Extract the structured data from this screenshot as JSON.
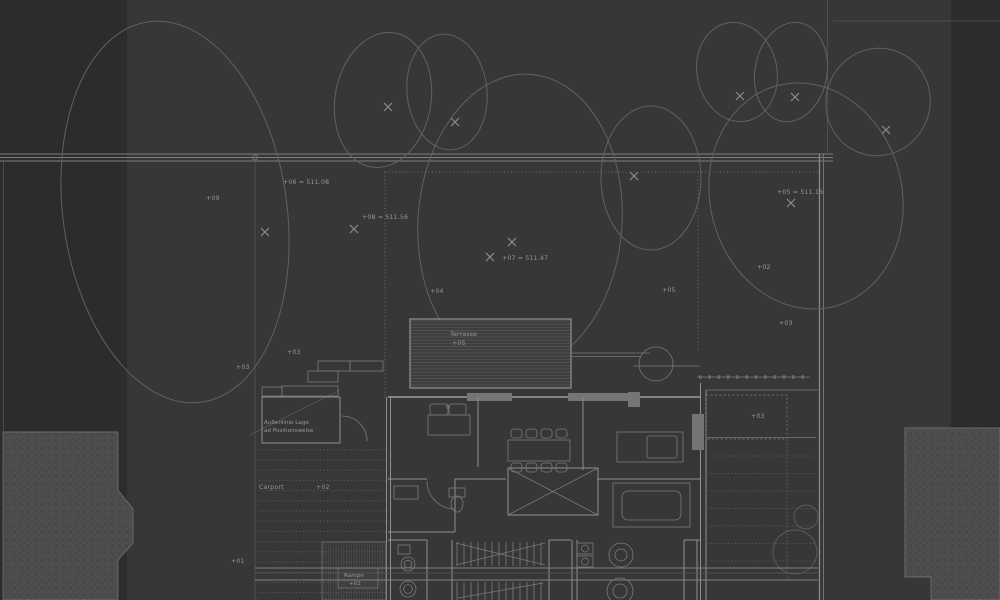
{
  "document": {
    "type": "architectural-site-plan",
    "style": "dark CAD / Lageplan view with tree canopies, neighbouring buildings and ground-floor furniture plan"
  },
  "colors": {
    "background": "#373737",
    "margin_strip": "#2c2c2c",
    "linework": "#8f8f8f",
    "tree_outline": "#616161",
    "hatch_fill": "#474747",
    "annotation_text": "#969696"
  },
  "icons": {
    "tree_position_marker": "x-cross",
    "boundary_node": "small-circle"
  },
  "annotations": {
    "spot_levels": [
      "+09",
      "+06 = 511.08",
      "+08 = 511.56",
      "+07 = 511.47",
      "+05 = 511.16",
      "+04",
      "+05",
      "+02",
      "+03",
      "+03",
      "+03",
      "+03",
      "+01"
    ]
  },
  "rooms": {
    "terrace": {
      "label": "Terrasse",
      "level": "+05"
    },
    "storage_box": {
      "line1": "Außenlinie Lage",
      "line2": "ad Positionsweise"
    },
    "carport": {
      "label": "Carport",
      "level": "+02"
    },
    "ramp": {
      "label": "Rampe",
      "level": "+02"
    }
  }
}
